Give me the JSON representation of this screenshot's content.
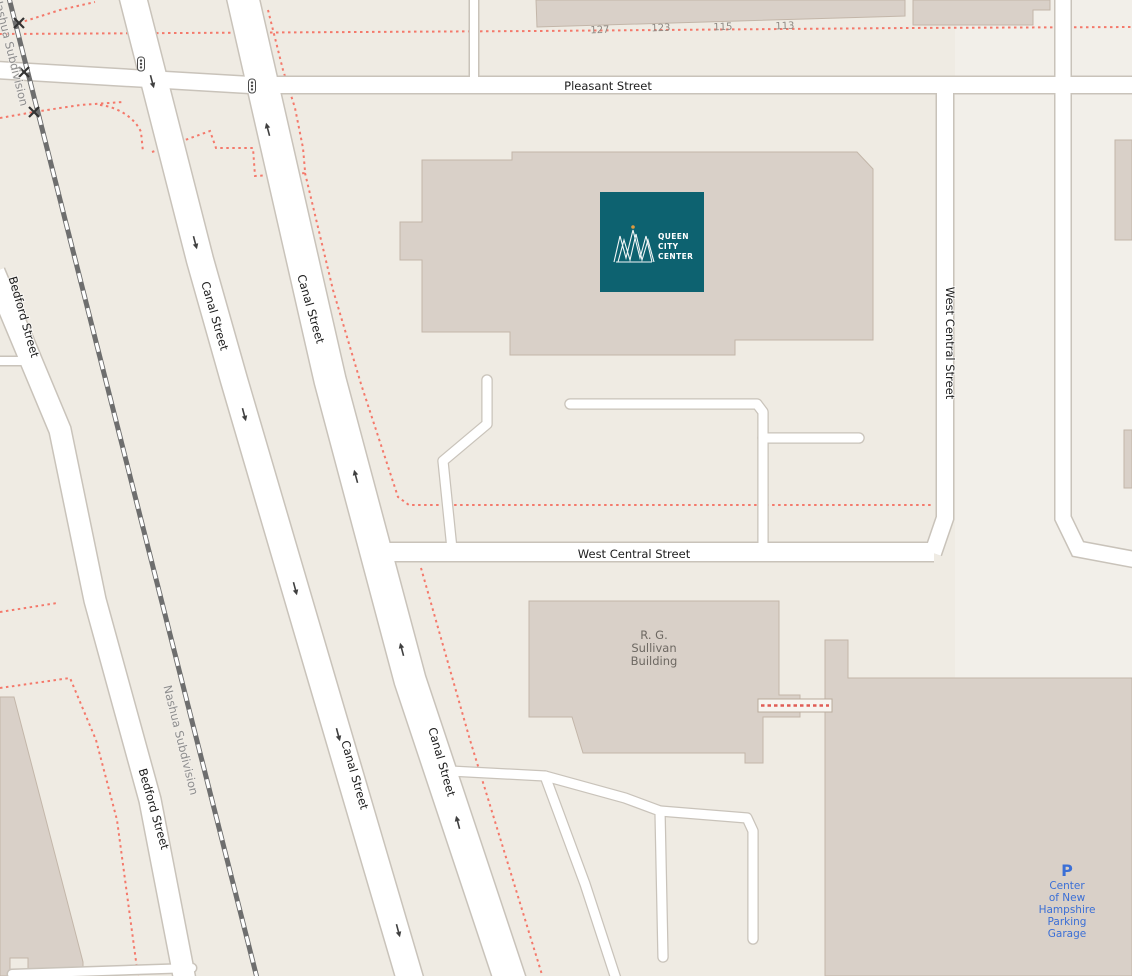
{
  "labels": {
    "pleasant_street": "Pleasant Street",
    "canal_street": "Canal Street",
    "bedford_street": "Bedford Street",
    "west_central_street": "West Central Street",
    "nashua_subdivision": "Nashua Subdivision"
  },
  "house_numbers": [
    "127",
    "123",
    "115",
    "113"
  ],
  "buildings": {
    "queen_city_center": {
      "name_lines": [
        "QUEEN",
        "CITY",
        "CENTER"
      ],
      "panel_color": "#0d6270",
      "crown_color": "#ffffff",
      "accent_dot_color": "#dd9b3e"
    },
    "rg_sullivan": {
      "name_lines": [
        "R. G.",
        "Sullivan",
        "Building"
      ]
    },
    "parking_garage": {
      "icon": "P",
      "name_lines": [
        "Center",
        "of New",
        "Hampshire",
        "Parking",
        "Garage"
      ],
      "text_color": "#3b6fd6"
    }
  },
  "colors": {
    "background": "#efebe3",
    "background_east": "#f2efe9",
    "road_fill": "#ffffff",
    "road_casing": "#c9c3ba",
    "building_fill": "#d9d0c8",
    "building_stroke": "#c3b6a9",
    "railway": "#6e6e6e",
    "boundary_dotted": "#f4796b",
    "street_label": "#1c1c1c",
    "rail_label": "#8e8e8e",
    "house_number": "#8f8a84",
    "sullivan_label": "#6d6862",
    "oneway_arrow": "#3f3f3f"
  }
}
